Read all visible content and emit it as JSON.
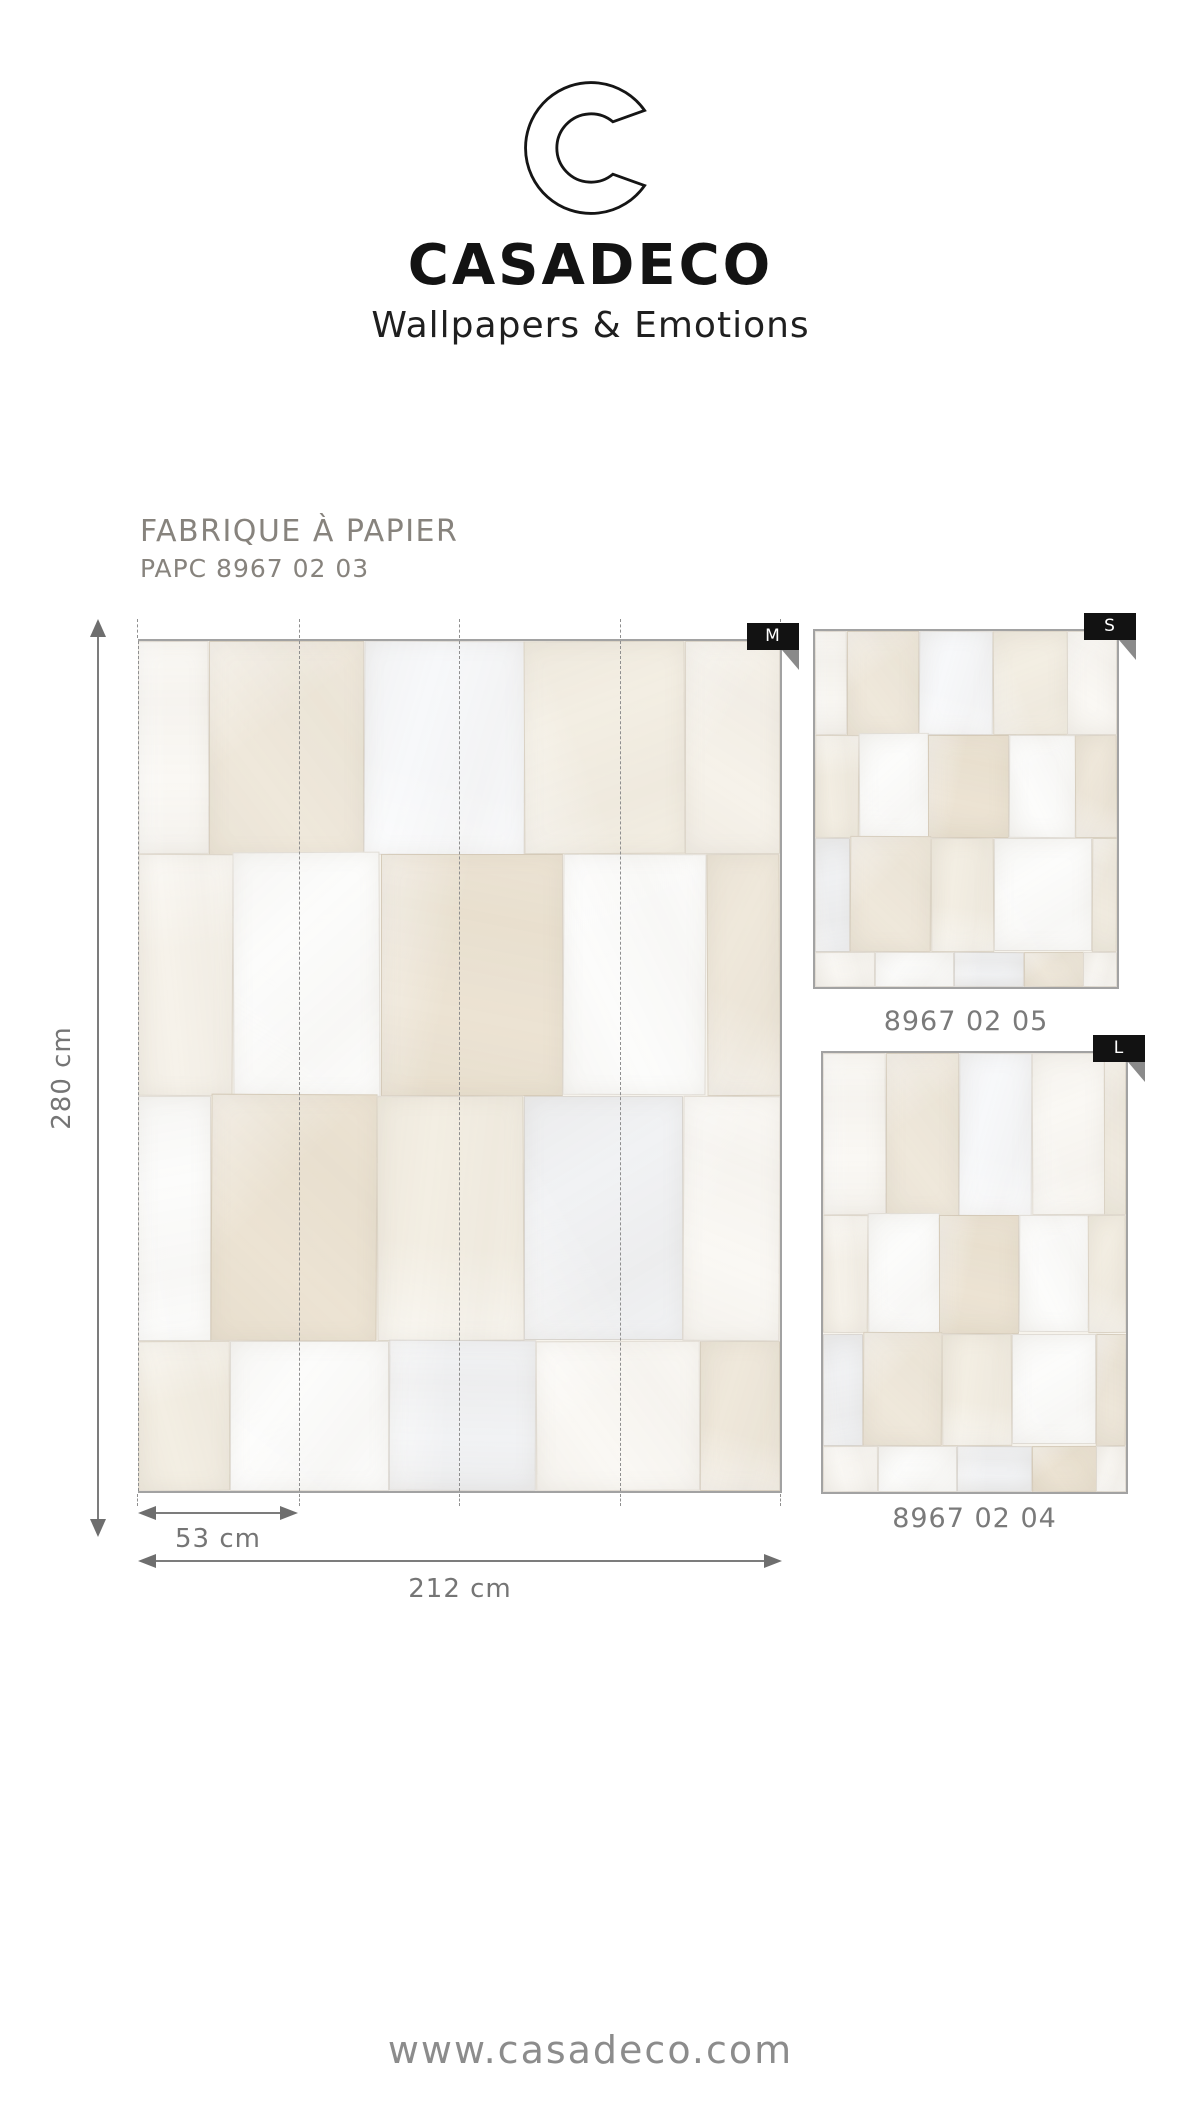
{
  "brand": {
    "logo_letter": "C",
    "name": "CASADECO",
    "tagline": "Wallpapers & Emotions"
  },
  "product": {
    "collection": "FABRIQUE À PAPIER",
    "reference": "PAPC 8967 02 03"
  },
  "dimensions": {
    "height_label": "280 cm",
    "panel_label": "53 cm",
    "width_label": "212 cm"
  },
  "swatches": [
    {
      "size_label": "M",
      "pattern": {
        "width": 640,
        "height": 850,
        "base": "#f6f3ec",
        "patches": [
          [
            0,
            0,
            71,
            213,
            0
          ],
          [
            71,
            0,
            154,
            215,
            1
          ],
          [
            225,
            0,
            160,
            214,
            2
          ],
          [
            385,
            0,
            160,
            213,
            3
          ],
          [
            545,
            0,
            95,
            213,
            4
          ],
          [
            0,
            213,
            95,
            242,
            4
          ],
          [
            95,
            211,
            147,
            245,
            5
          ],
          [
            242,
            213,
            182,
            242,
            6
          ],
          [
            424,
            213,
            143,
            241,
            5
          ],
          [
            567,
            213,
            73,
            242,
            1
          ],
          [
            0,
            455,
            73,
            245,
            5
          ],
          [
            73,
            453,
            165,
            247,
            6
          ],
          [
            238,
            455,
            147,
            245,
            3
          ],
          [
            385,
            455,
            158,
            244,
            7
          ],
          [
            543,
            455,
            97,
            245,
            0
          ],
          [
            0,
            700,
            92,
            150,
            3
          ],
          [
            92,
            700,
            158,
            150,
            5
          ],
          [
            250,
            699,
            147,
            151,
            7
          ],
          [
            397,
            700,
            163,
            150,
            0
          ],
          [
            560,
            700,
            80,
            150,
            1
          ]
        ]
      }
    },
    {
      "size_label": "S",
      "reference": "8967 02 05",
      "pattern": {
        "width": 304,
        "height": 356,
        "base": "#f6f3ec",
        "patches": [
          [
            0,
            0,
            32,
            104,
            0
          ],
          [
            32,
            0,
            73,
            105,
            1
          ],
          [
            105,
            0,
            74,
            104,
            2
          ],
          [
            179,
            0,
            75,
            104,
            3
          ],
          [
            254,
            0,
            50,
            104,
            0
          ],
          [
            0,
            104,
            44,
            103,
            3
          ],
          [
            44,
            102,
            70,
            105,
            5
          ],
          [
            114,
            104,
            81,
            103,
            6
          ],
          [
            195,
            104,
            67,
            103,
            5
          ],
          [
            262,
            104,
            42,
            103,
            1
          ],
          [
            0,
            207,
            35,
            114,
            7
          ],
          [
            35,
            205,
            82,
            116,
            1
          ],
          [
            117,
            207,
            63,
            114,
            3
          ],
          [
            180,
            207,
            99,
            113,
            5
          ],
          [
            279,
            207,
            25,
            114,
            3
          ],
          [
            0,
            321,
            60,
            35,
            0
          ],
          [
            60,
            321,
            80,
            35,
            5
          ],
          [
            140,
            321,
            70,
            35,
            7
          ],
          [
            210,
            321,
            60,
            35,
            1
          ],
          [
            270,
            321,
            34,
            35,
            0
          ]
        ]
      }
    },
    {
      "size_label": "L",
      "reference": "8967 02 04",
      "pattern": {
        "width": 305,
        "height": 441,
        "base": "#f6f3ec",
        "patches": [
          [
            0,
            0,
            63,
            163,
            0
          ],
          [
            63,
            0,
            74,
            164,
            1
          ],
          [
            137,
            0,
            73,
            164,
            2
          ],
          [
            210,
            0,
            73,
            163,
            0
          ],
          [
            283,
            0,
            22,
            163,
            3
          ],
          [
            0,
            163,
            45,
            119,
            4
          ],
          [
            45,
            161,
            72,
            121,
            5
          ],
          [
            117,
            163,
            80,
            119,
            6
          ],
          [
            197,
            163,
            70,
            118,
            5
          ],
          [
            267,
            163,
            38,
            119,
            3
          ],
          [
            0,
            282,
            40,
            113,
            7
          ],
          [
            40,
            280,
            80,
            115,
            1
          ],
          [
            120,
            282,
            70,
            113,
            3
          ],
          [
            190,
            282,
            85,
            111,
            5
          ],
          [
            275,
            282,
            30,
            113,
            1
          ],
          [
            0,
            395,
            55,
            46,
            0
          ],
          [
            55,
            395,
            80,
            46,
            5
          ],
          [
            135,
            395,
            75,
            46,
            7
          ],
          [
            210,
            395,
            65,
            46,
            6
          ],
          [
            275,
            395,
            30,
            46,
            0
          ]
        ]
      }
    }
  ],
  "palette": [
    "#faf8f4",
    "#efe8db",
    "#f7f8fa",
    "#f3eee3",
    "#f6f2ea",
    "#fcfcfb",
    "#ece3d3",
    "#f1f2f4"
  ],
  "colors": {
    "tab_background": "#121212",
    "tab_text": "#ffffff",
    "swatch_border": "#a2a2a2",
    "seam_dash": "#8f8f8f",
    "dimension_gray": "#757575",
    "title_gray": "#87837d",
    "brand_black": "#131313",
    "footer_gray": "#8c8c8c"
  },
  "footer": {
    "website": "www.casadeco.com"
  }
}
